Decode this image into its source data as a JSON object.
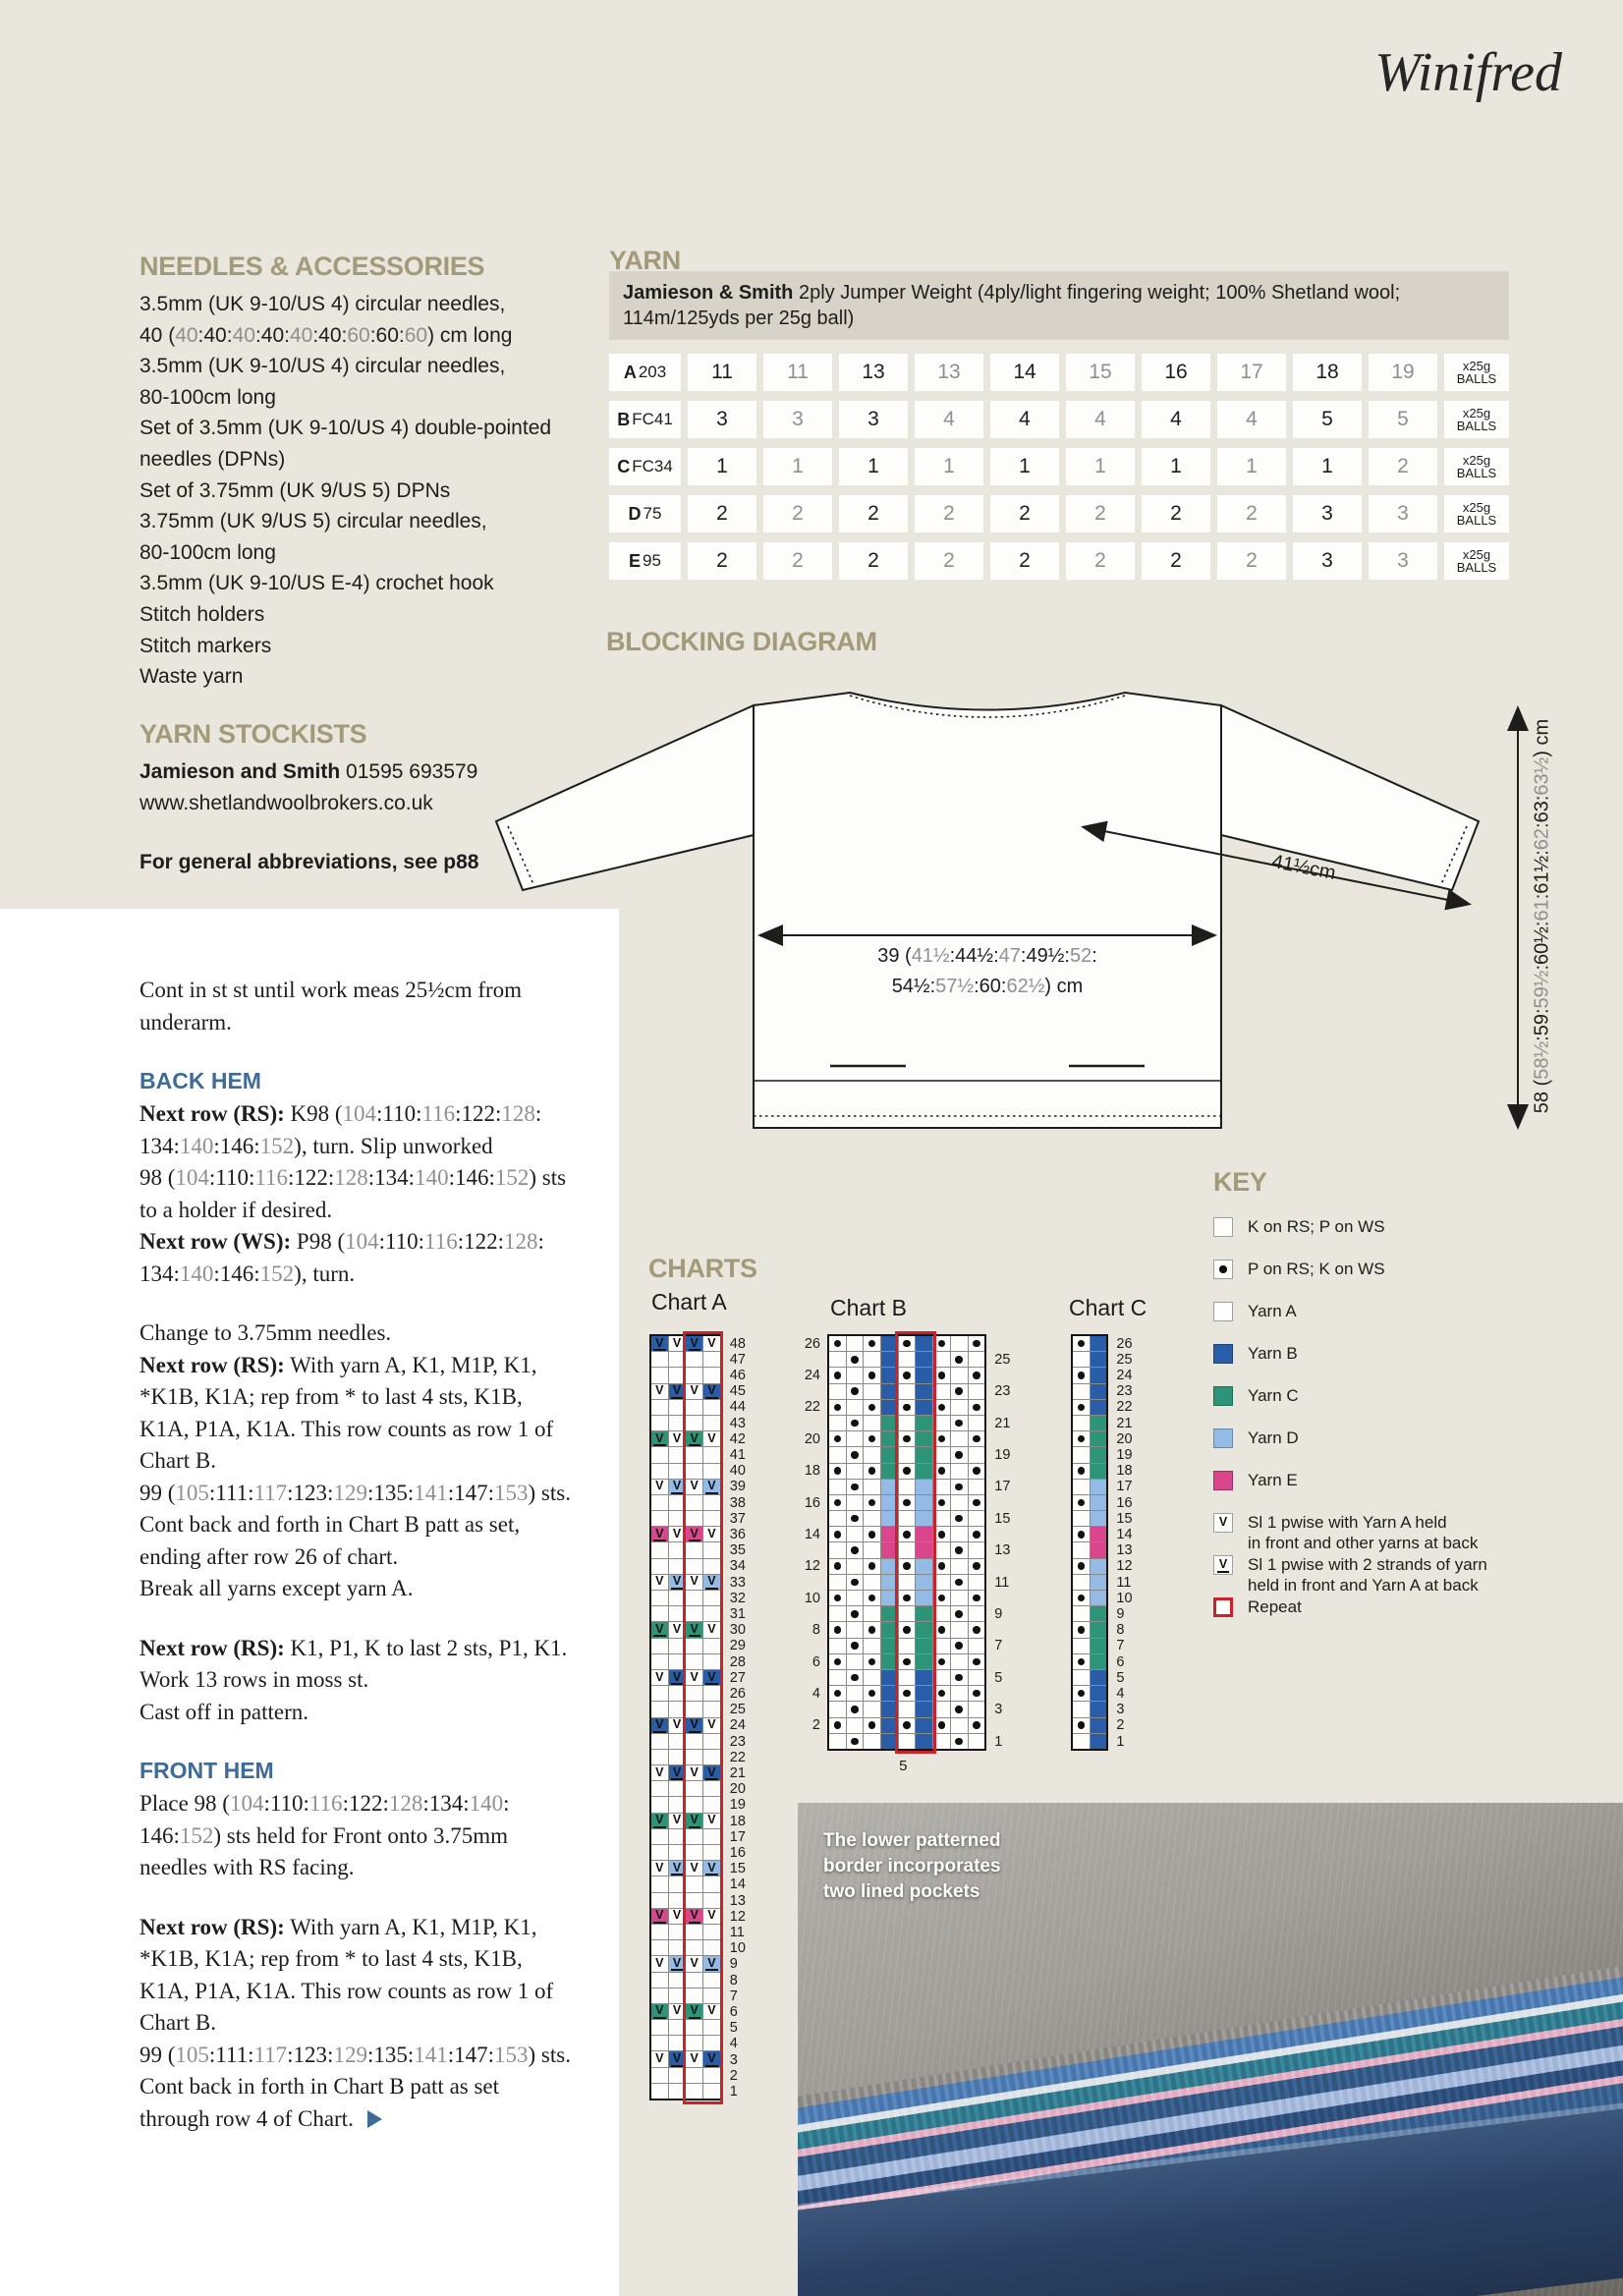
{
  "page": {
    "title": "Winifred"
  },
  "colors": {
    "background": "#e9e6de",
    "panel": "#ffffff",
    "heading": "#a29a78",
    "subheading": "#3f6b98",
    "body": "#1d1d1b",
    "muted": "#8f8f8d",
    "table_header_bg": "#d7d3c8",
    "repeat_red": "#cd2027",
    "yarn": {
      "A": "#fdfdfb",
      "B": "#2a5da8",
      "C": "#2d9478",
      "D": "#94bae6",
      "E": "#d9468c"
    }
  },
  "needles": {
    "heading": "NEEDLES & ACCESSORIES",
    "lines_text": "3.5mm (UK 9-10/US 4) circular needles,\n40 ([[g]]40[[/]]:40:[[g]]40[[/]]:40:[[g]]40[[/]]:40:[[g]]60[[/]]:60:[[g]]60[[/]]) cm long\n3.5mm (UK 9-10/US 4) circular needles,\n80-100cm long\nSet of 3.5mm (UK 9-10/US 4) double-pointed\nneedles (DPNs)\nSet of 3.75mm (UK 9/US 5) DPNs\n3.75mm (UK 9/US 5) circular needles,\n80-100cm long\n3.5mm (UK 9-10/US E-4) crochet hook\nStitch holders\nStitch markers\nWaste yarn"
  },
  "stockists": {
    "heading": "YARN STOCKISTS",
    "lines_text": "[[b]]Jamieson and Smith[[/]] 01595 693579\nwww.shetlandwoolbrokers.co.uk",
    "note_text": "[[b]]For general abbreviations, see p88[[/]]"
  },
  "yarn": {
    "heading": "YARN",
    "blurb_text": "[[b]]Jamieson & Smith[[/]] 2ply Jumper Weight (4ply/light fingering weight; 100% Shetland wool;\n114m/125yds per 25g ball)",
    "unit_line1": "x25g",
    "unit_line2": "BALLS",
    "rows": [
      {
        "letter": "A",
        "code": "203",
        "values": [
          "11",
          "11",
          "13",
          "13",
          "14",
          "15",
          "16",
          "17",
          "18",
          "19"
        ]
      },
      {
        "letter": "B",
        "code": "FC41",
        "values": [
          "3",
          "3",
          "3",
          "4",
          "4",
          "4",
          "4",
          "4",
          "5",
          "5"
        ]
      },
      {
        "letter": "C",
        "code": "FC34",
        "values": [
          "1",
          "1",
          "1",
          "1",
          "1",
          "1",
          "1",
          "1",
          "1",
          "2"
        ]
      },
      {
        "letter": "D",
        "code": "75",
        "values": [
          "2",
          "2",
          "2",
          "2",
          "2",
          "2",
          "2",
          "2",
          "3",
          "3"
        ]
      },
      {
        "letter": "E",
        "code": "95",
        "values": [
          "2",
          "2",
          "2",
          "2",
          "2",
          "2",
          "2",
          "2",
          "3",
          "3"
        ]
      }
    ]
  },
  "diagram": {
    "heading": "BLOCKING DIAGRAM",
    "width_label_text": "39 ([[g]]41½[[/]]:44½:[[g]]47[[/]]:49½:[[g]]52[[/]]:\n54½:[[g]]57½[[/]]:60:[[g]]62½[[/]]) cm",
    "sleeve_label_text": "41½cm",
    "height_label_text": "58 ([[g]]58½[[/]]:59:[[g]]59½[[/]]:60½:[[g]]61[[/]]:61½:[[g]]62[[/]]:63:[[g]]63½[[/]]) cm"
  },
  "pattern": {
    "blocks": [
      {
        "kind": "p",
        "text": "Cont in st st until work meas 25½cm from\nunderarm."
      },
      {
        "kind": "h",
        "text": "BACK HEM"
      },
      {
        "kind": "p",
        "text": "[[b]]Next row (RS):[[/]] K98 ([[g]]104[[/]]:110:[[g]]116[[/]]:122:[[g]]128[[/]]:\n134:[[g]]140[[/]]:146:[[g]]152[[/]]), turn. Slip unworked\n98 ([[g]]104[[/]]:110:[[g]]116[[/]]:122:[[g]]128[[/]]:134:[[g]]140[[/]]:146:[[g]]152[[/]]) sts\nto a holder if desired.\n[[b]]Next row (WS):[[/]] P98 ([[g]]104[[/]]:110:[[g]]116[[/]]:122:[[g]]128[[/]]:\n134:[[g]]140[[/]]:146:[[g]]152[[/]]), turn."
      },
      {
        "kind": "p",
        "text": "Change to 3.75mm needles.\n[[b]]Next row (RS):[[/]] With yarn A, K1, M1P, K1,\n*K1B, K1A; rep from * to last 4 sts, K1B,\nK1A, P1A, K1A. This row counts as row 1 of\nChart B.\n99 ([[g]]105[[/]]:111:[[g]]117[[/]]:123:[[g]]129[[/]]:135:[[g]]141[[/]]:147:[[g]]153[[/]]) sts.\nCont back and forth in Chart B patt as set,\nending after row 26 of chart.\nBreak all yarns except yarn A."
      },
      {
        "kind": "p",
        "text": "[[b]]Next row (RS):[[/]] K1, P1, K to last 2 sts, P1, K1.\nWork 13 rows in moss st.\nCast off in pattern."
      },
      {
        "kind": "h",
        "text": "FRONT HEM"
      },
      {
        "kind": "p",
        "text": "Place 98 ([[g]]104[[/]]:110:[[g]]116[[/]]:122:[[g]]128[[/]]:134:[[g]]140[[/]]:\n146:[[g]]152[[/]]) sts held for Front onto 3.75mm\nneedles with RS facing."
      },
      {
        "kind": "p",
        "tri": true,
        "text": "[[b]]Next row (RS):[[/]] With yarn A, K1, M1P, K1,\n*K1B, K1A; rep from * to last 4 sts, K1B,\nK1A, P1A, K1A. This row counts as row 1 of\nChart B.\n99 ([[g]]105[[/]]:111:[[g]]117[[/]]:123:[[g]]129[[/]]:135:[[g]]141[[/]]:147:[[g]]153[[/]]) sts.\nCont back in forth in Chart B patt as set\nthrough row 4 of Chart."
      }
    ]
  },
  "charts": {
    "heading": "CHARTS",
    "a": {
      "label": "Chart A",
      "cols": 4,
      "rows": 48,
      "repeat_cols": [
        3,
        4
      ],
      "numbers": "right-all",
      "patterned_rows": [
        {
          "row": 48,
          "color": "B",
          "cols": [
            1,
            3
          ]
        },
        {
          "row": 45,
          "color": "B",
          "cols": [
            2,
            4
          ]
        },
        {
          "row": 42,
          "color": "C",
          "cols": [
            1,
            3
          ]
        },
        {
          "row": 39,
          "color": "D",
          "cols": [
            2,
            4
          ]
        },
        {
          "row": 36,
          "color": "E",
          "cols": [
            1,
            3
          ]
        },
        {
          "row": 33,
          "color": "D",
          "cols": [
            2,
            4
          ]
        },
        {
          "row": 30,
          "color": "C",
          "cols": [
            1,
            3
          ]
        },
        {
          "row": 27,
          "color": "B",
          "cols": [
            2,
            4
          ]
        },
        {
          "row": 24,
          "color": "B",
          "cols": [
            1,
            3
          ]
        },
        {
          "row": 21,
          "color": "B",
          "cols": [
            2,
            4
          ]
        },
        {
          "row": 18,
          "color": "C",
          "cols": [
            1,
            3
          ]
        },
        {
          "row": 15,
          "color": "D",
          "cols": [
            2,
            4
          ]
        },
        {
          "row": 12,
          "color": "E",
          "cols": [
            1,
            3
          ]
        },
        {
          "row": 9,
          "color": "D",
          "cols": [
            2,
            4
          ]
        },
        {
          "row": 6,
          "color": "C",
          "cols": [
            1,
            3
          ]
        },
        {
          "row": 3,
          "color": "B",
          "cols": [
            2,
            4
          ]
        }
      ]
    },
    "b": {
      "label": "Chart B",
      "cols": 9,
      "rows": 26,
      "stripe_cols": [
        4,
        6
      ],
      "stripes": [
        {
          "from": 26,
          "to": 22,
          "color": "B"
        },
        {
          "from": 21,
          "to": 18,
          "color": "C"
        },
        {
          "from": 17,
          "to": 15,
          "color": "D"
        },
        {
          "from": 14,
          "to": 13,
          "color": "E"
        },
        {
          "from": 12,
          "to": 10,
          "color": "D"
        },
        {
          "from": 9,
          "to": 6,
          "color": "C"
        },
        {
          "from": 5,
          "to": 1,
          "color": "B"
        }
      ],
      "dots_even_cols": [
        1,
        3,
        5,
        7,
        9
      ],
      "dots_odd_cols": [
        2,
        8
      ],
      "repeat_cols": [
        5,
        6
      ],
      "numbers": "left-even-right-odd",
      "bottom_label": "5"
    },
    "c": {
      "label": "Chart C",
      "cols": 2,
      "rows": 26,
      "stripe_cols": [
        2
      ],
      "stripes": [
        {
          "from": 26,
          "to": 22,
          "color": "B"
        },
        {
          "from": 21,
          "to": 18,
          "color": "C"
        },
        {
          "from": 17,
          "to": 15,
          "color": "D"
        },
        {
          "from": 14,
          "to": 13,
          "color": "E"
        },
        {
          "from": 12,
          "to": 10,
          "color": "D"
        },
        {
          "from": 9,
          "to": 6,
          "color": "C"
        },
        {
          "from": 5,
          "to": 1,
          "color": "B"
        }
      ],
      "dots_even_cols": [
        1
      ],
      "numbers": "right-all"
    }
  },
  "key": {
    "heading": "KEY",
    "items": [
      {
        "icon": "knit",
        "label": "K on RS; P on WS"
      },
      {
        "icon": "purl",
        "label": "P on RS; K on WS"
      },
      {
        "icon": "yarnA",
        "label": "Yarn A"
      },
      {
        "icon": "yarnB",
        "label": "Yarn B"
      },
      {
        "icon": "yarnC",
        "label": "Yarn C"
      },
      {
        "icon": "yarnD",
        "label": "Yarn D"
      },
      {
        "icon": "yarnE",
        "label": "Yarn E"
      },
      {
        "icon": "slip1",
        "label": "Sl 1 pwise with Yarn A held\nin front and other yarns at back"
      },
      {
        "icon": "slip2",
        "label": "Sl 1 pwise with 2 strands of yarn\nheld in front and Yarn A at back"
      },
      {
        "icon": "repeat",
        "label": "Repeat"
      }
    ]
  },
  "photo": {
    "caption": "The lower patterned\nborder incorporates\ntwo lined pockets"
  }
}
